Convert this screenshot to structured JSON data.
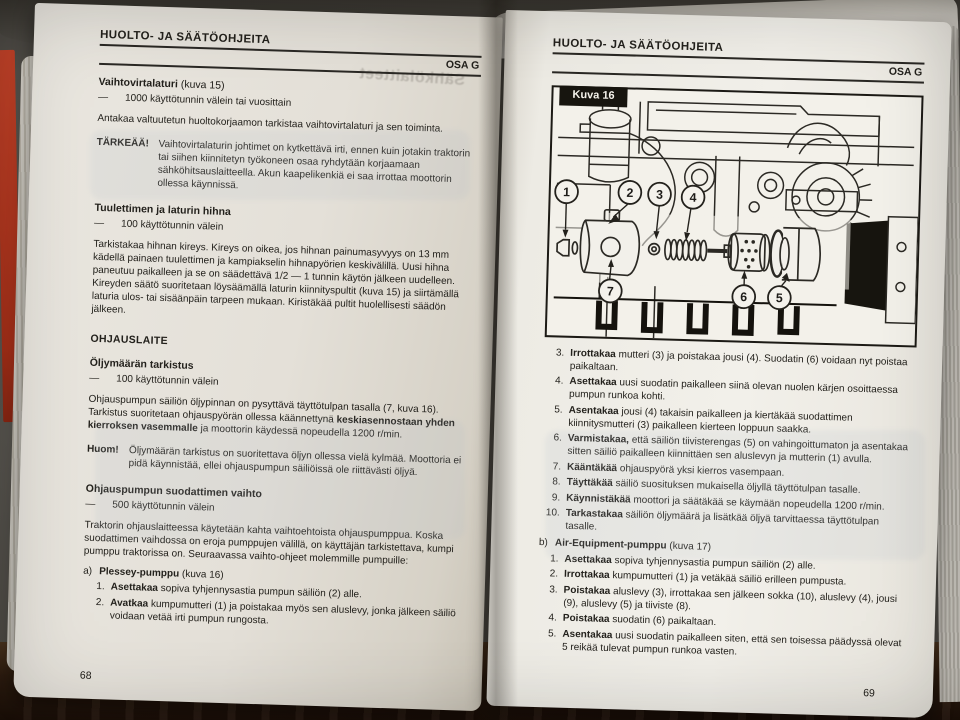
{
  "book": {
    "ghost_text": "Sähkölaitteet"
  },
  "left": {
    "header_title": "HUOLTO- JA SÄÄTÖOHJEITA",
    "header_section": "OSA G",
    "s1_heading": "Vaihtovirtalaturi",
    "s1_heading_ref": " (kuva 15)",
    "s1_dash": "—",
    "s1_interval": "1000 käyttötunnin välein tai vuosittain",
    "s1_para": "Antakaa valtuutetun huoltokorjaamon tarkistaa vaihtovirtalaturi ja sen toiminta.",
    "important_label": "TÄRKEÄÄ!",
    "important_text": "Vaihtovirtalaturin johtimet on kytkettävä irti, ennen kuin jotakin traktorin tai siihen kiinnitetyn työkoneen osaa ryhdytään korjaamaan sähköhitsauslaitteella. Akun kaapelikenkiä ei saa irrottaa moottorin ollessa käynnissä.",
    "s2_heading": "Tuulettimen ja laturin hihna",
    "s2_dash": "—",
    "s2_interval": "100 käyttötunnin välein",
    "s2_para": "Tarkistakaa hihnan kireys. Kireys on oikea, jos hihnan painumasyvyys on 13 mm kädellä painaen tuulettimen ja kampiakselin hihnapyörien keskivälillä. Uusi hihna paneutuu paikalleen ja se on säädettävä 1/2 — 1 tunnin käytön jälkeen uudelleen. Kireyden säätö suoritetaan löysäämällä laturin kiinnityspultit (kuva 15) ja siirtämällä laturia ulos- tai sisäänpäin tarpeen mukaan. Kiristäkää pultit huolellisesti säädön jälkeen.",
    "s3_heading": "OHJAUSLAITE",
    "s4_heading": "Öljymäärän tarkistus",
    "s4_dash": "—",
    "s4_interval": "100 käyttötunnin välein",
    "s4_para_1": "Ohjauspumpun säiliön öljypinnan on pysyttävä täyttötulpan tasalla (7, kuva 16). Tarkistus suoritetaan ohjauspyörän ollessa käännettynä ",
    "s4_para_bold": "keskiasennostaan yhden kierroksen vasemmalle",
    "s4_para_2": " ja moottorin käydessä nopeudella 1200 r/min.",
    "note_label": "Huom!",
    "note_text": "Öljymäärän tarkistus on suoritettava öljyn ollessa vielä kylmää. Moottoria ei pidä käynnistää, ellei ohjauspumpun säiliöissä ole riittävästi öljyä.",
    "s5_heading": "Ohjauspumpun suodattimen vaihto",
    "s5_dash": "—",
    "s5_interval": "500 käyttötunnin välein",
    "s5_para": "Traktorin ohjauslaitteessa käytetään kahta vaihtoehtoista ohjauspumppua. Koska suodattimen vaihdossa on eroja pumppujen välillä, on käyttäjän tarkistettava, kumpi pumppu traktorissa on. Seuraavassa vaihto-ohjeet molemmille pumpuille:",
    "list_a_label": "a)",
    "list_a_title": "Plessey-pumppu",
    "list_a_title_ref": " (kuva 16)",
    "list_a": [
      {
        "n": "1.",
        "v": "Asettakaa",
        "t": " sopiva tyhjennysastia pumpun säiliön (2) alle."
      },
      {
        "n": "2.",
        "v": "Avatkaa",
        "t": " kumpumutteri (1) ja poistakaa myös sen aluslevy, jonka jälkeen säiliö voidaan vetää irti pumpun rungosta."
      }
    ],
    "page_number": "68"
  },
  "right": {
    "header_title": "HUOLTO- JA SÄÄTÖOHJEITA",
    "header_section": "OSA G",
    "figure_label": "Kuva 16",
    "figure_callouts": [
      "1",
      "2",
      "3",
      "4",
      "5",
      "6",
      "7"
    ],
    "list_a": [
      {
        "n": "3.",
        "v": "Irrottakaa",
        "t": " mutteri (3) ja poistakaa jousi (4). Suodatin (6) voidaan nyt poistaa paikaltaan."
      },
      {
        "n": "4.",
        "v": "Asettakaa",
        "t": " uusi suodatin paikalleen siinä olevan nuolen kärjen osoittaessa pumpun runkoa kohti."
      },
      {
        "n": "5.",
        "v": "Asentakaa",
        "t": " jousi (4) takaisin paikalleen ja kiertäkää suodattimen kiinnitysmutteri (3) paikalleen kierteen loppuun saakka."
      },
      {
        "n": "6.",
        "v": "Varmistakaa,",
        "t": " että säiliön tiivisterengas (5) on vahingoittumaton ja asentakaa sitten säiliö paikalleen kiinnittäen sen aluslevyn ja mutterin (1) avulla."
      },
      {
        "n": "7.",
        "v": "Kääntäkää",
        "t": " ohjauspyörä yksi kierros vasempaan."
      },
      {
        "n": "8.",
        "v": "Täyttäkää",
        "t": " säiliö suosituksen mukaisella öljyllä täyttötulpan tasalle."
      },
      {
        "n": "9.",
        "v": "Käynnistäkää",
        "t": " moottori ja säätäkää se käymään nopeudella 1200 r/min."
      },
      {
        "n": "10.",
        "v": "Tarkastakaa",
        "t": " säiliön öljymäärä ja lisätkää öljyä tarvittaessa täyttötulpan tasalle."
      }
    ],
    "list_b_label": "b)",
    "list_b_title": "Air-Equipment-pumppu",
    "list_b_title_ref": " (kuva 17)",
    "list_b": [
      {
        "n": "1.",
        "v": "Asettakaa",
        "t": " sopiva tyhjennysastia pumpun säiliön (2) alle."
      },
      {
        "n": "2.",
        "v": "Irrottakaa",
        "t": " kumpumutteri (1) ja vetäkää säiliö erilleen pumpusta."
      },
      {
        "n": "3.",
        "v": "Poistakaa",
        "t": " aluslevy (3), irrottakaa sen jälkeen sokka (10), aluslevy (4), jousi (9), aluslevy (5) ja tiiviste (8)."
      },
      {
        "n": "4.",
        "v": "Poistakaa",
        "t": " suodatin (6) paikaltaan."
      },
      {
        "n": "5.",
        "v": "Asentakaa",
        "t": " uusi suodatin paikalleen siten, että sen toisessa päädyssä olevat 5 reikää tulevat pumpun runkoa vasten."
      }
    ],
    "page_number": "69"
  }
}
